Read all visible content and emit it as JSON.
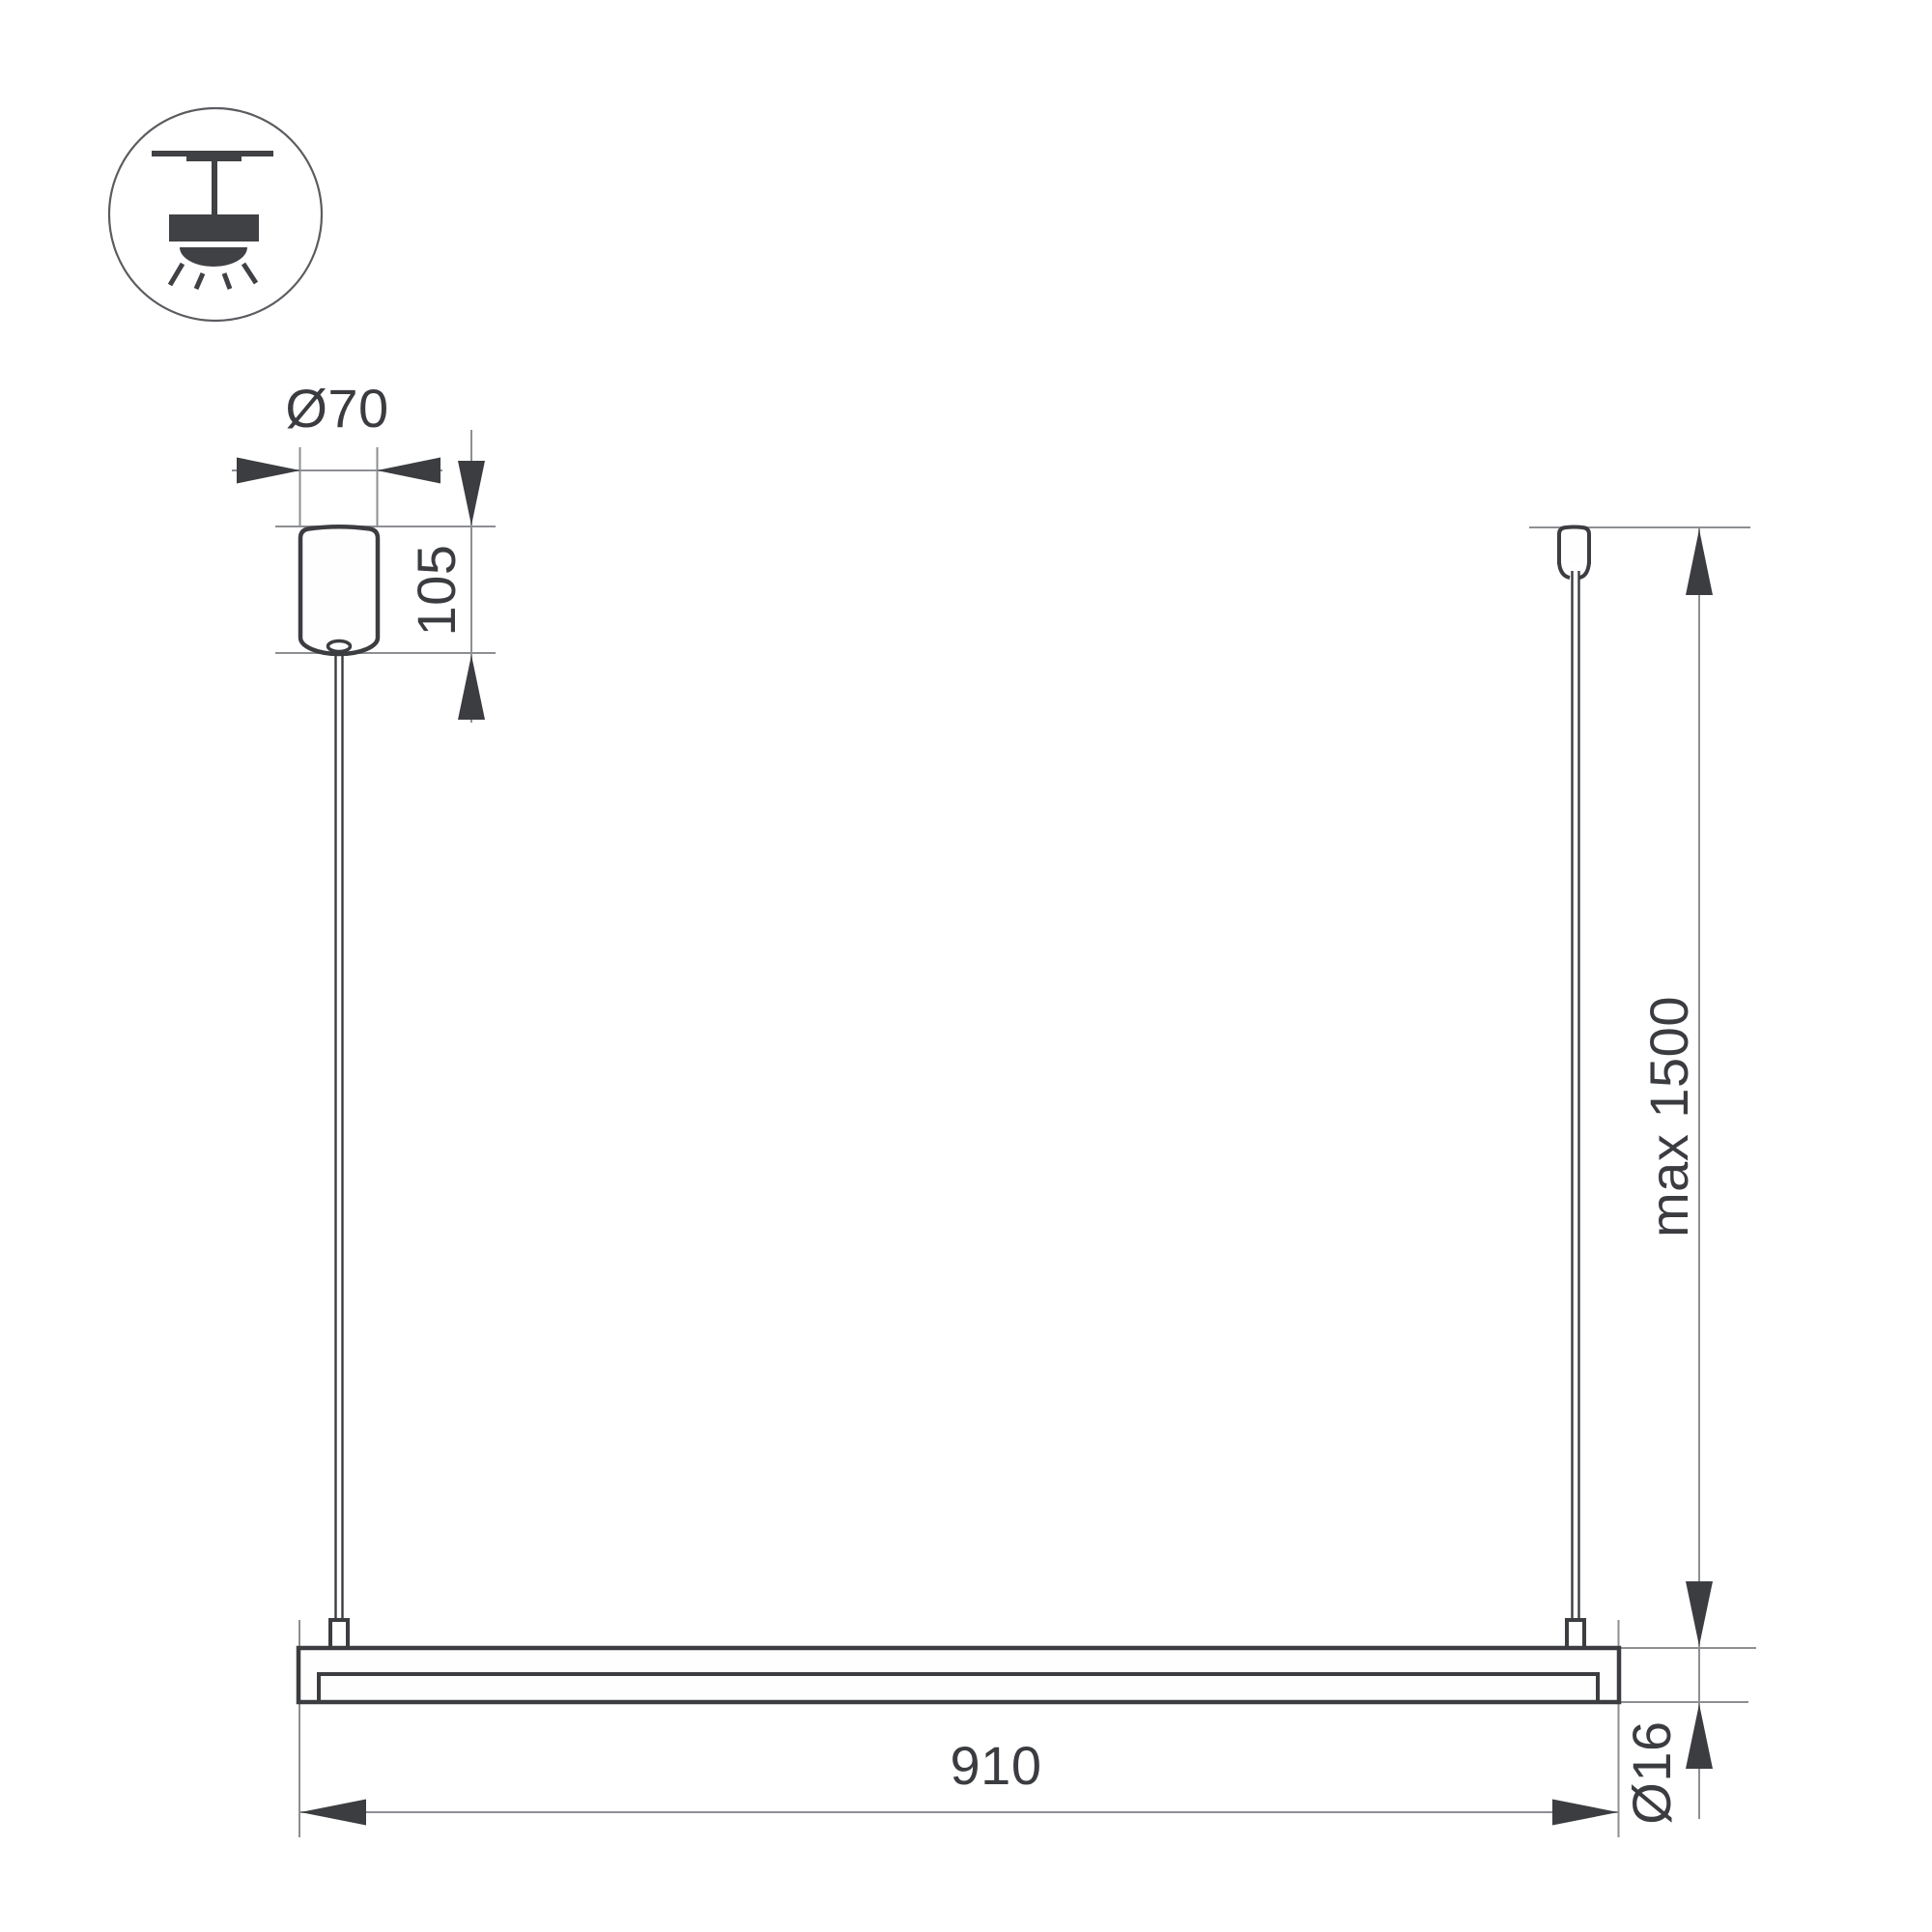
{
  "drawing": {
    "kind": "luminaire-suspension-dimension-drawing",
    "icon": {
      "name": "pendant-ceiling-mount-icon"
    },
    "labels": {
      "canopy_diameter": "Ø70",
      "canopy_height": "105",
      "suspension_length": "max 1500",
      "fixture_length": "910",
      "tube_diameter": "Ø16"
    },
    "values": {
      "canopy_diameter_mm": 70,
      "canopy_height_mm": 105,
      "suspension_max_mm": 1500,
      "fixture_length_mm": 910,
      "tube_diameter_mm": 16
    },
    "colors": {
      "outline_dark": "#3b3d41",
      "dimension_thin": "#8d8f92",
      "text": "#3a3c40",
      "background": "#ffffff"
    }
  }
}
